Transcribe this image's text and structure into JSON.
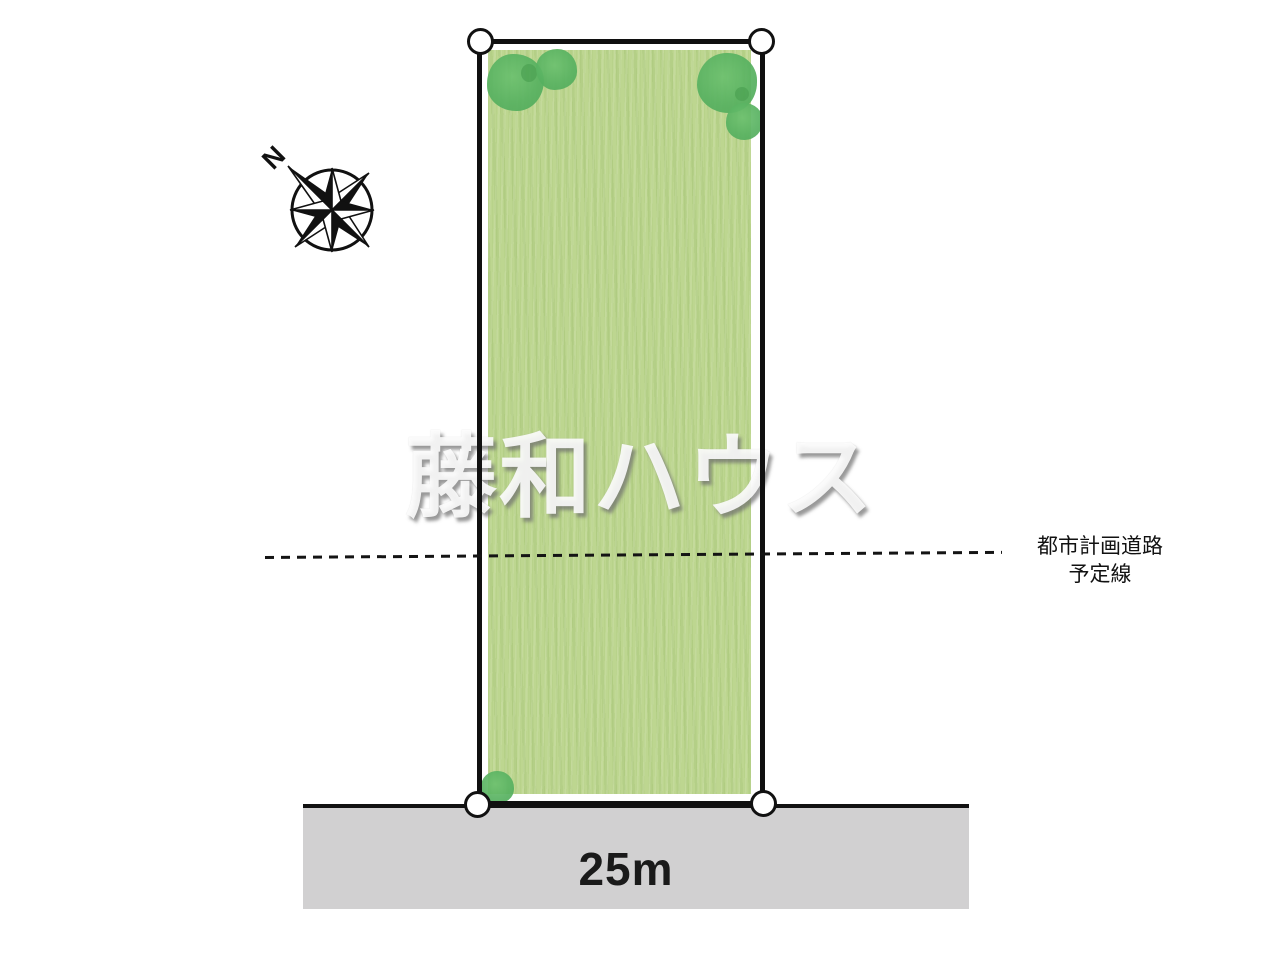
{
  "diagram": {
    "watermark_text": "藤和ハウス",
    "road": {
      "width_label": "25m"
    },
    "planned_road_label": {
      "line1": "都市計画道路",
      "line2": "予定線"
    },
    "compass": {
      "north_label": "N"
    },
    "colors": {
      "plot_fill": "#bdd690",
      "tree_green": "#5db763",
      "road_fill": "#d1d0d1",
      "outline_black": "#111111",
      "watermark_shadow": "#6e6e6e"
    },
    "icons": {
      "compass": "compass-rose-icon",
      "tree": "tree-icon",
      "corner_marker": "survey-marker-icon"
    }
  }
}
